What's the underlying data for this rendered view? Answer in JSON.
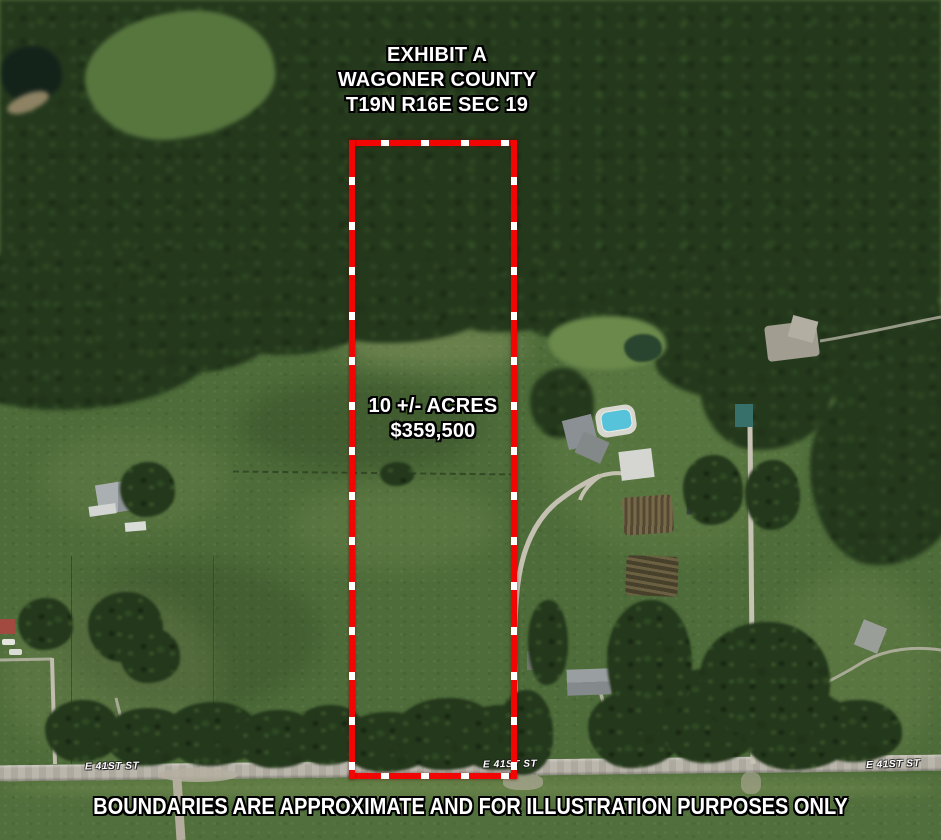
{
  "exhibit": {
    "title_line1": "EXHIBIT A",
    "title_line2": "WAGONER COUNTY",
    "title_line3": "T19N R16E SEC 19",
    "acreage": "10 +/- ACRES",
    "price": "$359,500",
    "disclaimer": "BOUNDARIES ARE APPROXIMATE AND FOR ILLUSTRATION PURPOSES ONLY"
  },
  "streets": {
    "left": "E 41ST ST",
    "center": "E 41ST ST",
    "right": "E 41ST ST"
  },
  "boundary": {
    "style": "red dashed rectangle",
    "color": "#f10603",
    "dash_color": "#ffffff"
  },
  "colors": {
    "forest_green": "#24381c",
    "pasture_green": "#4d6c39",
    "road_gray": "#b6b2a7",
    "pool_blue": "#57c3da",
    "text_white": "#ffffff",
    "text_outline_black": "#000000"
  }
}
